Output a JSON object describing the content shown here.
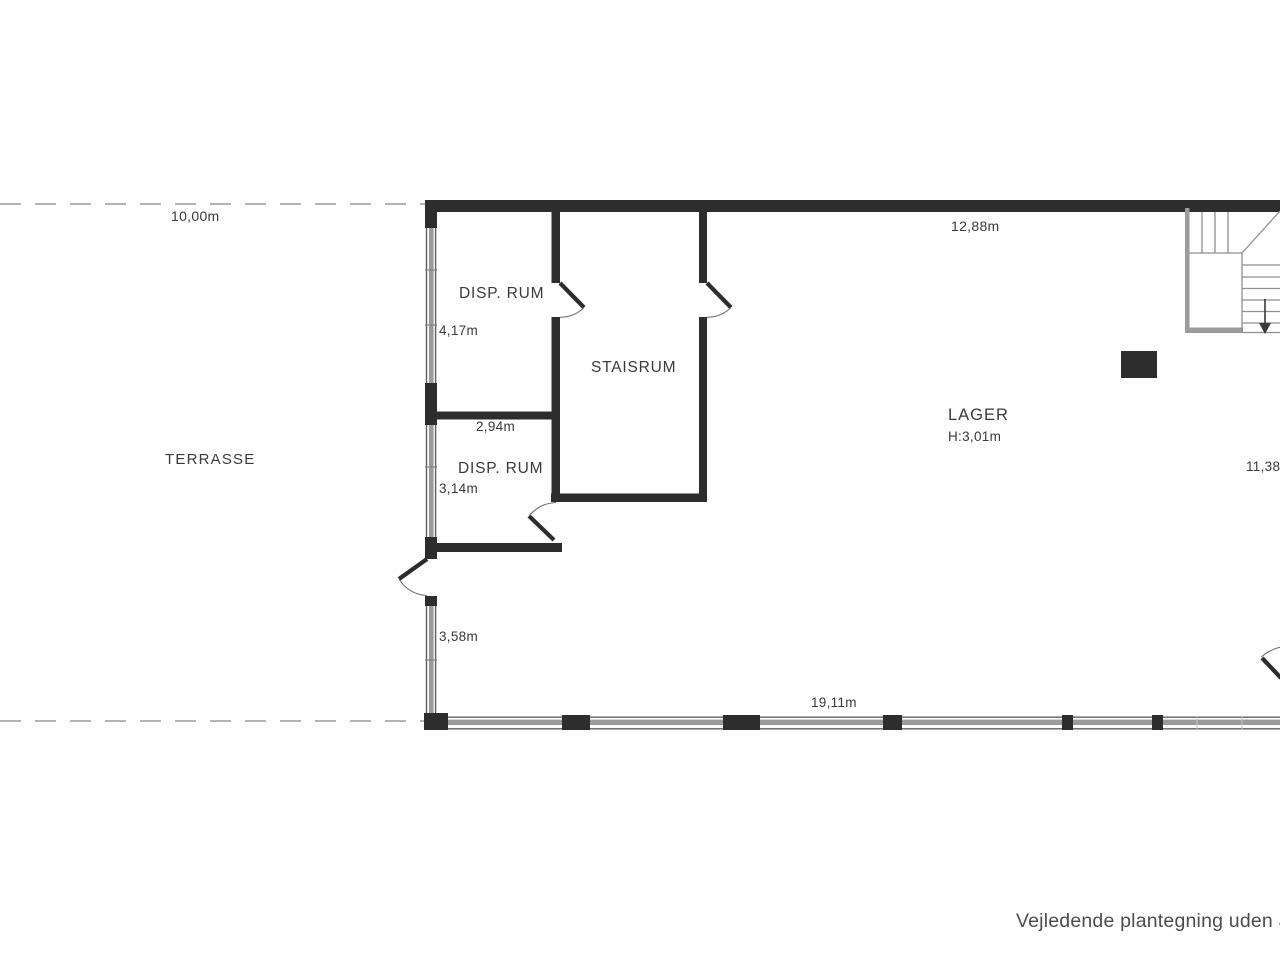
{
  "rooms": {
    "terrasse": {
      "label": "TERRASSE"
    },
    "disp_rum_1": {
      "label": "DISP. RUM",
      "dim": "4,17m"
    },
    "disp_rum_2": {
      "label": "DISP. RUM",
      "dim_top": "2,94m",
      "dim": "3,14m"
    },
    "staisrum": {
      "label": "STAISRUM"
    },
    "lager": {
      "label": "LAGER",
      "ceiling_height": "H:3,01m"
    }
  },
  "dimensions": {
    "terrace_top_width": "10,00m",
    "lager_top_width": "12,88m",
    "lager_right_depth": "11,38m",
    "left_lower_height": "3,58m",
    "bottom_width": "19,11m"
  },
  "footer": {
    "disclaimer": "Vejledende plantegning uden a"
  },
  "colors": {
    "wall": "#2d2d2d",
    "window": "#9b9b9b",
    "windowEdge": "#5e5e5e",
    "stair": "#9b9b9b",
    "stairLine": "#8f8f8f",
    "doorArc": "#6f6f6f",
    "dashed": "#b4b4b4",
    "text": "#3a3a3a",
    "footerText": "#4d4d4d",
    "bg": "#fefefe"
  }
}
